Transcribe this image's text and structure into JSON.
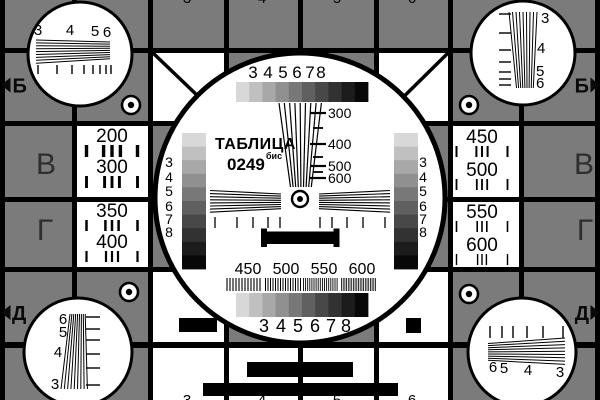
{
  "card": {
    "title": "ТАБЛИЦА",
    "number": "0249",
    "number_suffix": "бис"
  },
  "colors": {
    "background": "#7b7b7b",
    "line": "#000000",
    "white": "#ffffff",
    "row_letter": "#2e2e2e"
  },
  "grayscale_steps": [
    "#d8d8d8",
    "#c0c0c0",
    "#a8a8a8",
    "#909090",
    "#787878",
    "#606060",
    "#484848",
    "#323232",
    "#1c1c1c",
    "#080808"
  ],
  "center_circle": {
    "top_numbers": [
      "3",
      "4",
      "5",
      "6",
      "7",
      "8"
    ],
    "bottom_numbers": [
      "3",
      "4",
      "5",
      "6",
      "7",
      "8"
    ],
    "left_bar_numbers": [
      "3",
      "4",
      "5",
      "6",
      "7",
      "8"
    ],
    "right_bar_numbers": [
      "3",
      "4",
      "5",
      "6",
      "7",
      "8"
    ],
    "wedge_labels": [
      "300",
      "400",
      "500",
      "600"
    ],
    "burst_labels": [
      "450",
      "500",
      "550",
      "600"
    ]
  },
  "corner_circles": {
    "top_left": [
      "3",
      "4",
      "5",
      "6"
    ],
    "top_right": [
      "3",
      "4",
      "5",
      "6"
    ],
    "bottom_left": [
      "6",
      "5",
      "4",
      "3"
    ],
    "bottom_right": [
      "6",
      "5",
      "4",
      "3"
    ]
  },
  "resolution_cells": {
    "left_top": [
      "200",
      "300"
    ],
    "left_bottom": [
      "350",
      "400"
    ],
    "right_top": [
      "450",
      "500"
    ],
    "right_bottom": [
      "550",
      "600"
    ]
  },
  "row_letters": {
    "left": [
      "Б",
      "В",
      "Г",
      "Д"
    ],
    "right": [
      "Б",
      "В",
      "Г",
      "Д"
    ]
  },
  "column_digits": {
    "top": [
      "3",
      "4",
      "5",
      "6"
    ],
    "bottom": [
      "3",
      "4",
      "5",
      "6"
    ]
  }
}
